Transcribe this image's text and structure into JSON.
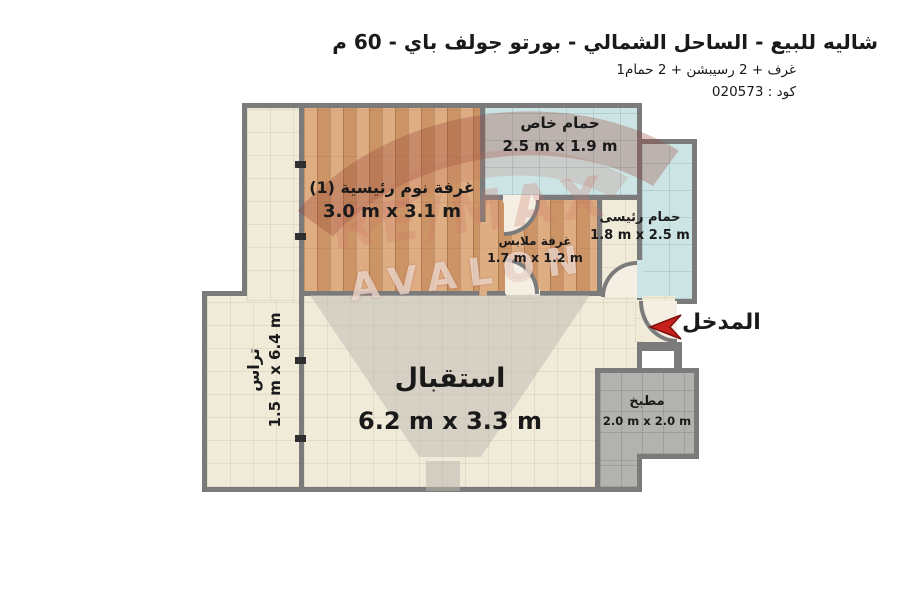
{
  "header": {
    "title": "شاليه للبيع - الساحل الشمالي - بورتو جولف باي - 60 م",
    "summary": "1غرف + 2 رسيبشن + 2 حمام",
    "code": "كود : 020573"
  },
  "entrance": {
    "label": "المدخل"
  },
  "watermark": {
    "brand": "RE/MAX",
    "name": "AVALON"
  },
  "rooms": {
    "bedroom": {
      "name": "غرفة نوم رئيسية (1)",
      "dims": "3.0 m x 3.1 m"
    },
    "bath_private": {
      "name": "حمام خاص",
      "dims": "2.5 m x 1.9 m"
    },
    "bath_master": {
      "name": "حمام رئيسى",
      "dims": "1.8 m x 2.5 m"
    },
    "dressing": {
      "name": "غرفة ملابس",
      "dims": "1.7 m x 1.2 m"
    },
    "terrace": {
      "name": "تراس",
      "dims": "1.5 m x 6.4 m"
    },
    "reception": {
      "name": "استقبال",
      "dims": "6.2 m x 3.3 m"
    },
    "kitchen": {
      "name": "مطبخ",
      "dims": "2.0 m x 2.0 m"
    }
  },
  "colors": {
    "wall": "#7b7b7b",
    "floor_tile": "#f0ead9",
    "wood": "#dca87d",
    "bath_tile": "#cde4e4",
    "kitchen_tile": "#b2b2ae",
    "entrance_arrow": "#c8201d"
  }
}
